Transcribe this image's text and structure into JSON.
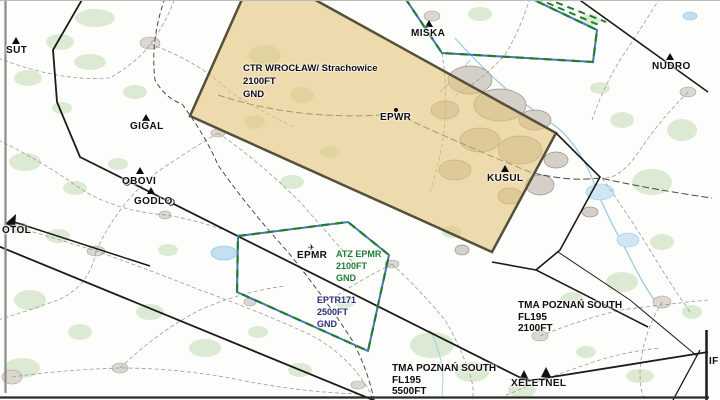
{
  "chart_title": "VFR map extract (Wrocław area)",
  "airspace_labels": {
    "ctr": {
      "name": "CTR WROCŁAW/ Strachowice",
      "upper": "2100FT",
      "lower": "GND"
    },
    "atz": {
      "name": "ATZ EPMR",
      "upper": "2100FT",
      "lower": "GND"
    },
    "eptr171": {
      "name": "EPTR171",
      "upper": "2500FT",
      "lower": "GND"
    },
    "tma_east": {
      "name": "TMA POZNAŃ SOUTH",
      "upper": "FL195",
      "lower": "2100FT"
    },
    "tma_bottom": {
      "name": "TMA POZNAŃ SOUTH",
      "upper": "FL195",
      "lower": "5500FT"
    }
  },
  "airports": {
    "epwr": "EPWR",
    "epmr": "EPMR"
  },
  "waypoints": {
    "sut": "SUT",
    "gigal": "GIGAL",
    "obovi": "OBOVI",
    "godlo": "GODLO",
    "otol": "OTOL",
    "miska": "MIŚKA",
    "nudro": "NUDRO",
    "kusul": "KUSUL",
    "xeletnel": "XELETNEL",
    "if_edge": "IF"
  },
  "icons": {
    "airfield": "✈"
  },
  "colors": {
    "ctr_fill": "#e3c57d",
    "ctr_border": "#55503a",
    "atz_blue": "#4a74b4",
    "atz_green_dash": "#1e7d33",
    "boundary_black": "#1b1b1b",
    "eptr_text": "#2d2d73",
    "atz_text": "#1e7d33",
    "forest": "#dcead3",
    "water": "#9ccbe2",
    "town": "#dcd8d1"
  }
}
